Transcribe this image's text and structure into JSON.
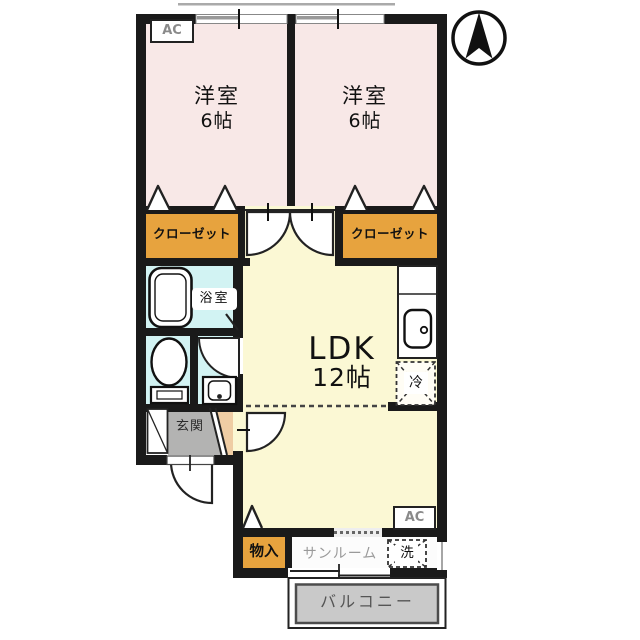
{
  "floorplan": {
    "type": "japanese-apartment-floor-plan",
    "compass": "north-arrow",
    "rooms": {
      "bedroom1": {
        "name": "洋室",
        "size": "6帖"
      },
      "bedroom2": {
        "name": "洋室",
        "size": "6帖"
      },
      "closet1": {
        "label": "クローゼット"
      },
      "closet2": {
        "label": "クローゼット"
      },
      "bathroom": {
        "label": "浴室"
      },
      "ldk": {
        "name": "LDK",
        "size": "12帖"
      },
      "entrance": {
        "label": "玄関"
      },
      "storage": {
        "label": "物入"
      },
      "sunroom": {
        "label": "サンルーム"
      },
      "balcony": {
        "label": "バルコニー"
      }
    },
    "appliances": {
      "ac_top": {
        "label": "AC"
      },
      "ac_bottom": {
        "label": "AC"
      },
      "washer": {
        "label": "洗"
      },
      "fridge": {
        "label": "冷"
      }
    },
    "colors": {
      "bedroom_fill": "#f8e8e7",
      "closet_fill": "#e7a33e",
      "ldk_fill": "#fbf8d4",
      "wet_area_fill": "#d2f3f3",
      "entrance_tile": "#b3b3b2",
      "hall_fill": "#efcda4",
      "balcony_fill": "#c9c9c9",
      "wall": "#1a1a1a"
    }
  }
}
